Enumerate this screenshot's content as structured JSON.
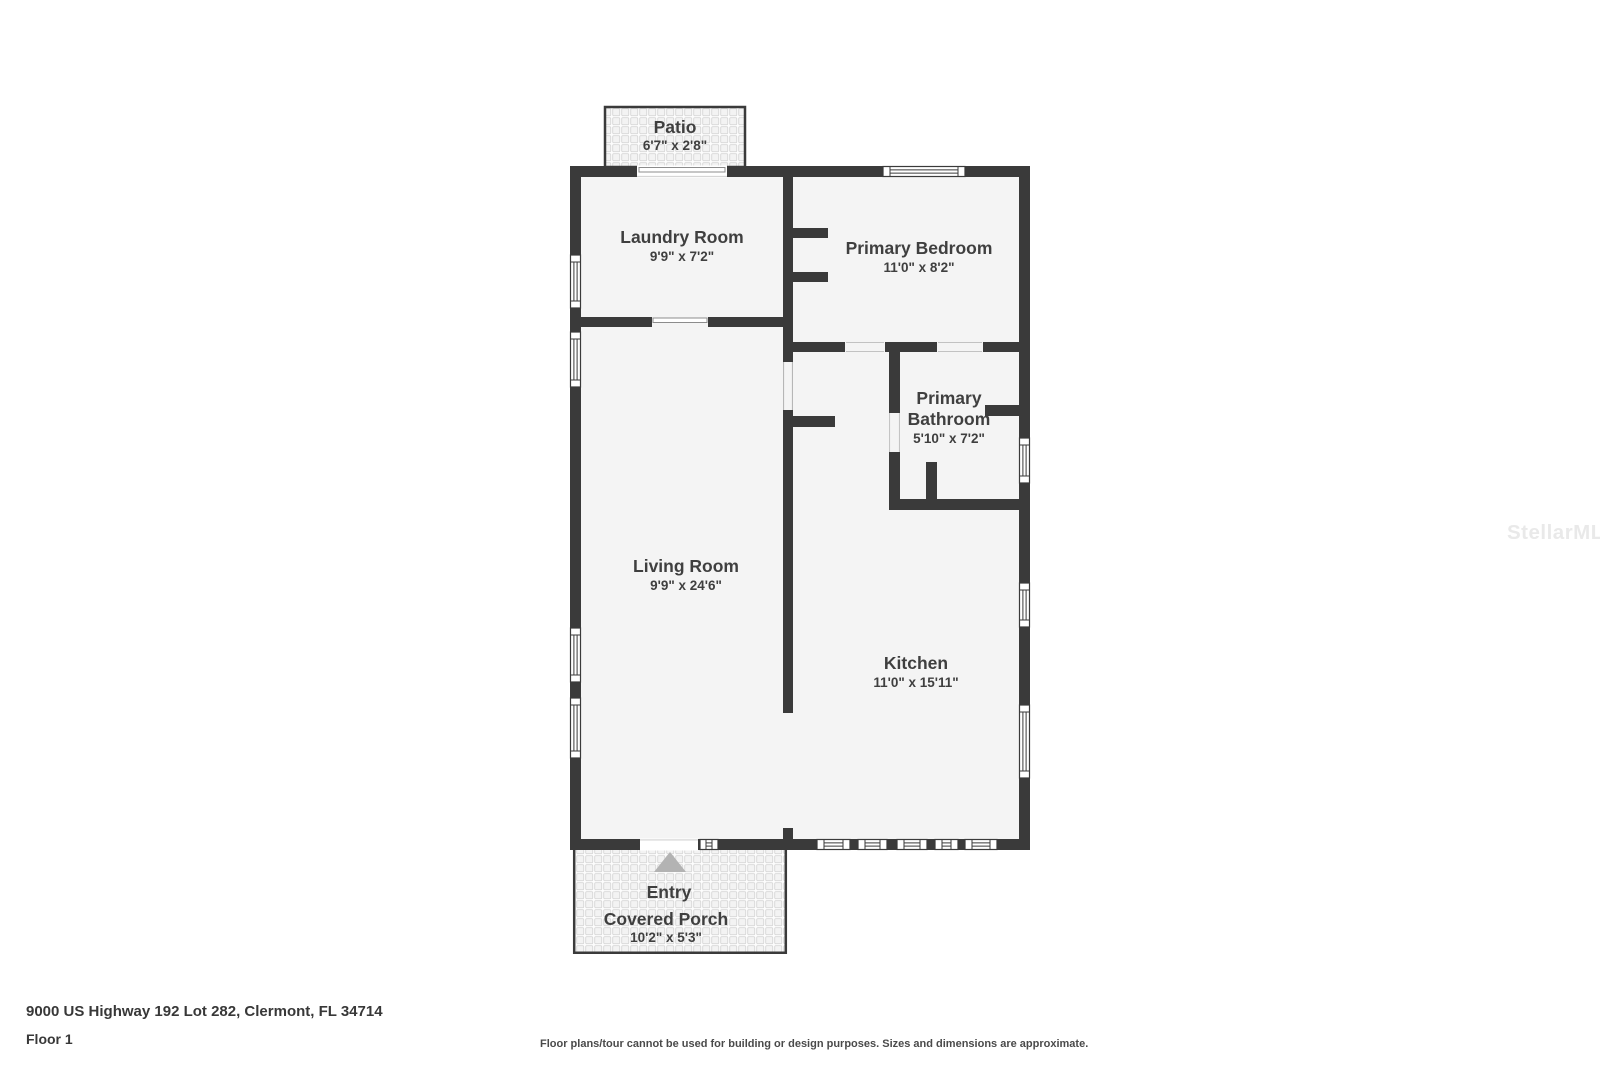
{
  "watermark": {
    "text": "StellarMLS",
    "color": "#e9e9e9"
  },
  "plan": {
    "rooms": {
      "patio": {
        "name": "Patio",
        "dims": "6'7\" x 2'8\""
      },
      "laundry_room": {
        "name": "Laundry Room",
        "dims": "9'9\" x 7'2\""
      },
      "primary_bedroom": {
        "name": "Primary Bedroom",
        "dims": "11'0\" x 8'2\""
      },
      "primary_bathroom": {
        "name_line1": "Primary",
        "name_line2": "Bathroom",
        "dims": "5'10\" x 7'2\""
      },
      "living_room": {
        "name": "Living Room",
        "dims": "9'9\" x 24'6\""
      },
      "kitchen": {
        "name": "Kitchen",
        "dims": "11'0\" x 15'11\""
      },
      "entry": {
        "name": "Entry"
      },
      "covered_porch": {
        "name": "Covered Porch",
        "dims": "10'2\" x 5'3\""
      }
    },
    "colors": {
      "wall": "#3a3a3a",
      "room_fill": "#f4f4f4",
      "label_text": "#3f3f3f",
      "entry_arrow": "#b3b3b3",
      "tile_line": "#d7d7d7"
    }
  },
  "footer": {
    "address": "9000 US Highway 192 Lot 282, Clermont, FL 34714",
    "floor_label": "Floor 1",
    "disclaimer": "Floor plans/tour cannot be used for building or design purposes. Sizes and dimensions are approximate."
  }
}
